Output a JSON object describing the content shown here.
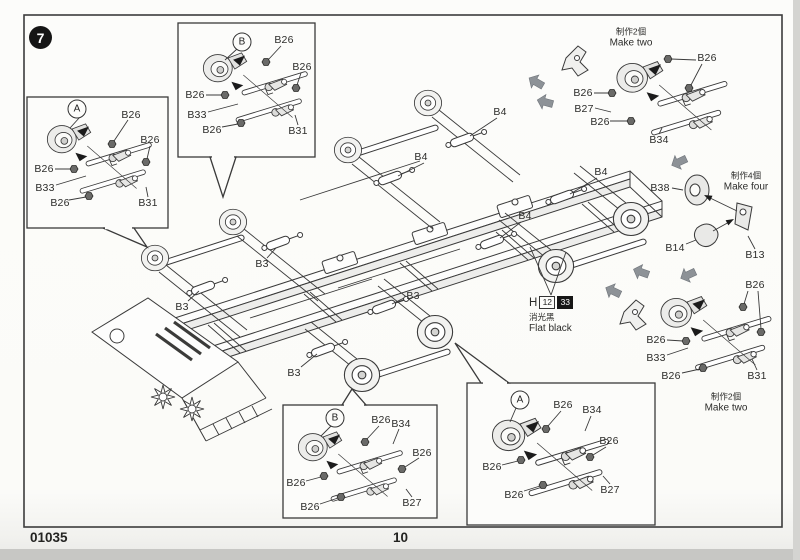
{
  "page": {
    "step": "7",
    "kit_number": "01035",
    "page_number": "10"
  },
  "paint": {
    "prefix": "H",
    "code_white": "12",
    "code_black": "33",
    "name_zh": "消光黑",
    "name_en": "Flat black"
  },
  "notes": {
    "make_two_zh": "制作2個",
    "make_two_en": "Make two",
    "make_four_zh": "制作4個",
    "make_four_en": "Make four"
  },
  "insets": {
    "top_left": {
      "badge": "A",
      "labels": [
        "B26",
        "B26",
        "B26",
        "B33",
        "B26",
        "B31"
      ]
    },
    "top_mid": {
      "badge": "B",
      "labels": [
        "B26",
        "B26",
        "B26",
        "B33",
        "B26",
        "B31"
      ]
    },
    "bottom_mid": {
      "badge": "B",
      "labels": [
        "B26",
        "B34",
        "B26",
        "B26",
        "B26",
        "B27"
      ]
    },
    "bottom_right": {
      "badge": "A",
      "labels": [
        "B26",
        "B34",
        "B26",
        "B26",
        "B26",
        "B27"
      ]
    }
  },
  "groups": {
    "top_right": {
      "labels": [
        "B26",
        "B26",
        "B27",
        "B26",
        "B34"
      ]
    },
    "mid_right": {
      "labels": [
        "B38",
        "B14",
        "B13"
      ]
    },
    "bottom_right": {
      "labels": [
        "B26",
        "B26",
        "B33",
        "B26",
        "B31"
      ]
    }
  },
  "main": {
    "b4": [
      "B4",
      "B4",
      "B4",
      "B4"
    ],
    "b3": [
      "B3",
      "B3",
      "B3",
      "B3"
    ]
  }
}
